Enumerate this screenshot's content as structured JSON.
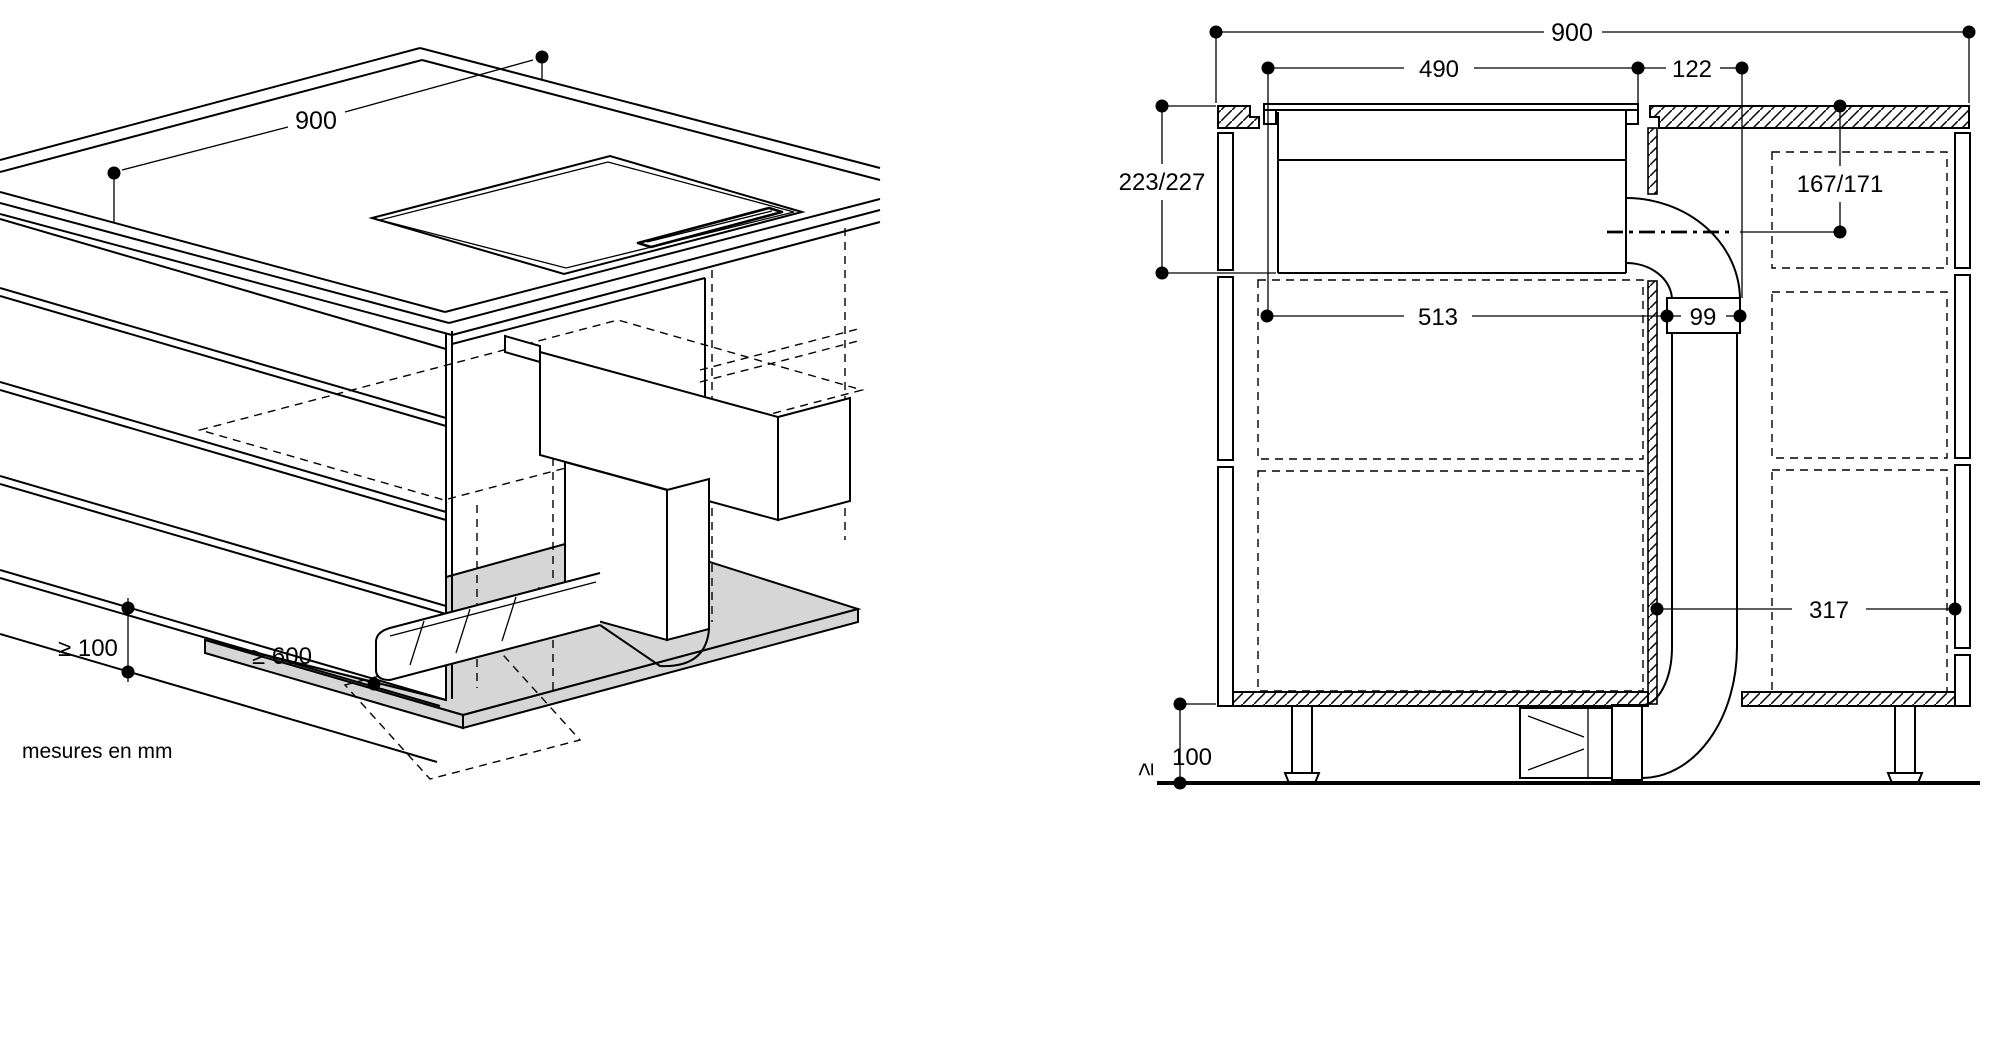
{
  "colors": {
    "ink": "#000000",
    "background": "#ffffff",
    "panel_shade": "#d6d6d6"
  },
  "isometric_view": {
    "dim_width": "900",
    "dim_plinth": "≥ 100",
    "dim_clearance": "≥ 600"
  },
  "section_view": {
    "dim_total_width": "900",
    "dim_cutout_width": "490",
    "dim_offset": "122",
    "dim_depth": "223/227",
    "dim_outlet_axis": "167/171",
    "dim_clear_width": "513",
    "dim_duct": "99",
    "dim_side_clearance": "317",
    "dim_plinth_symbol": "≥",
    "dim_plinth_value": "100"
  },
  "footer": {
    "units_note": "mesures en mm"
  }
}
